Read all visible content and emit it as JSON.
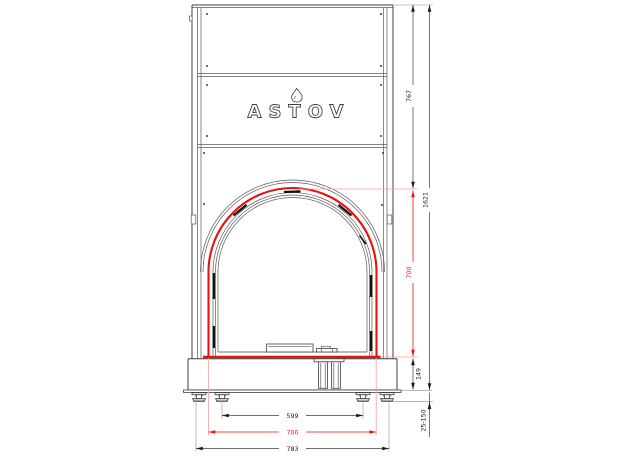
{
  "brand": {
    "logo_text": "ASTOV"
  },
  "dimensions": {
    "upper_height": "767",
    "total_height": "1621",
    "opening_height": "700",
    "plinth_height": "149",
    "leg_range": "25-150",
    "leg_spacing": "599",
    "opening_width": "700",
    "overall_width": "783"
  },
  "colors": {
    "line": "#3f3f3f",
    "line_light": "#8f8f8f",
    "accent": "#e8120f",
    "accent_light": "#f5a2a0",
    "text": "#1a1a1a",
    "bg": "#ffffff"
  }
}
